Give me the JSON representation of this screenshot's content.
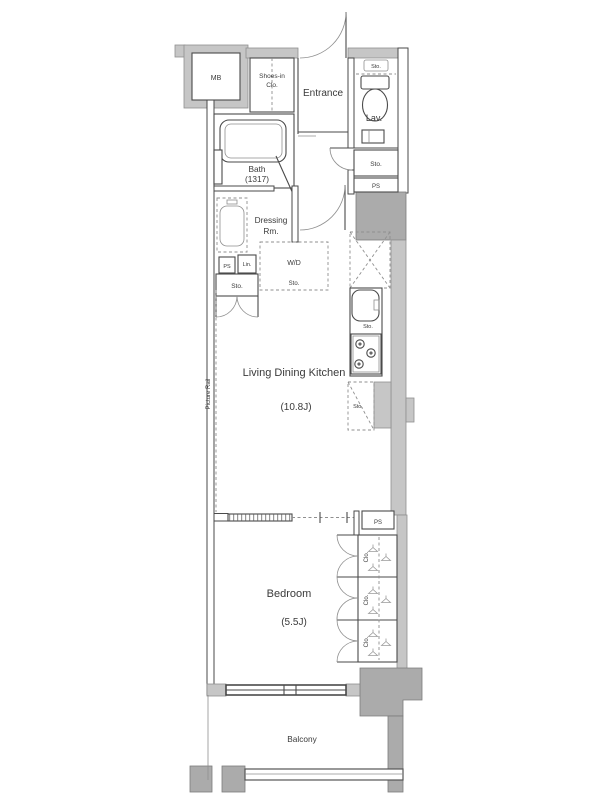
{
  "colors": {
    "bg": "#ffffff",
    "wall-light": "#c6c6c6",
    "wall-dark": "#ababab",
    "line": "#4a4a4a",
    "line-light": "#8f8f8f",
    "text": "#3a3a3a"
  },
  "labels": {
    "mb": "MB",
    "shoes_line1": "Shoes-in",
    "shoes_line2": "Clo.",
    "entrance": "Entrance",
    "sto": "Sto.",
    "lav": "Lav.",
    "ps": "PS",
    "bath_line1": "Bath",
    "bath_line2": "(1317)",
    "dressing_line1": "Dressing",
    "dressing_line2": "Rm.",
    "lin": "Lin.",
    "wd": "W/D",
    "ldk_line1": "Living Dining Kitchen",
    "ldk_line2": "(10.8J)",
    "picture_rail": "Picture Rail",
    "bedroom_line1": "Bedroom",
    "bedroom_line2": "(5.5J)",
    "clo": "Clo.",
    "balcony": "Balcony"
  }
}
